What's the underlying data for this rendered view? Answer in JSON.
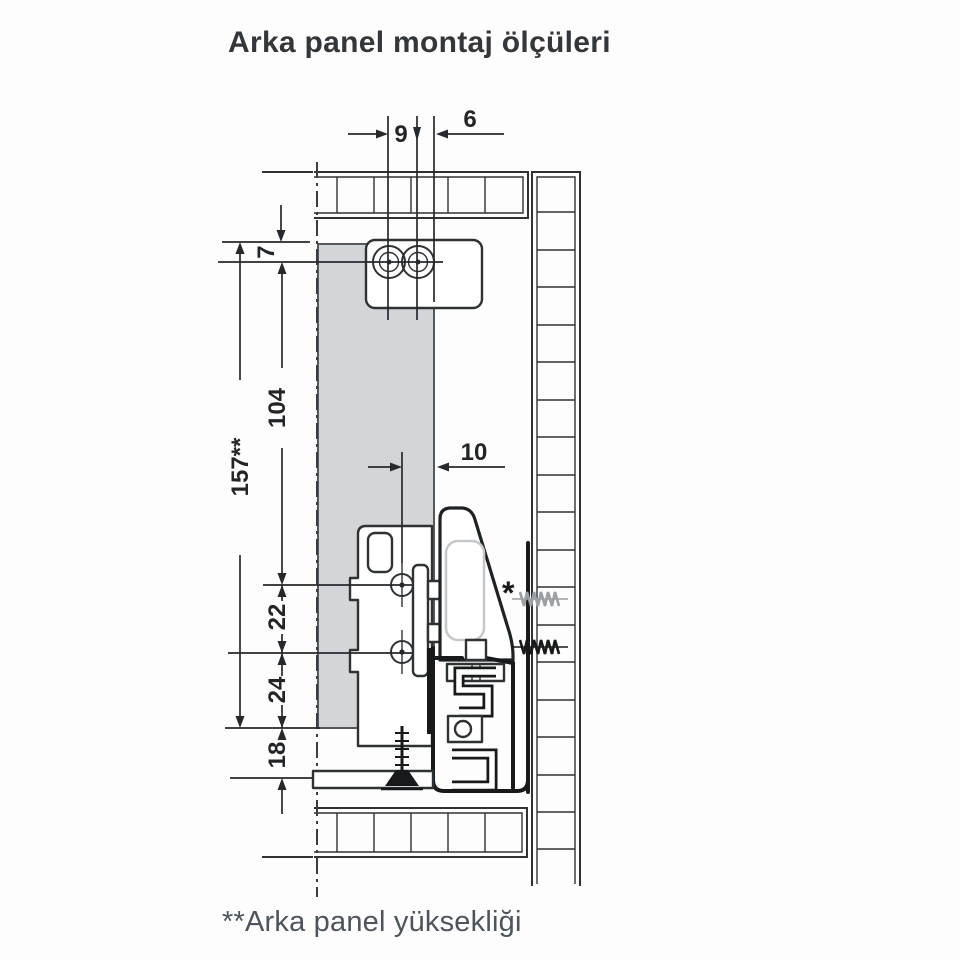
{
  "title": "Arka panel montaj ölçüleri",
  "footnote": "**Arka panel yüksekliği",
  "dimensions": {
    "screw_spacing_top": "9",
    "edge_offset_top": "6",
    "top_to_first_row": "7",
    "row_span": "104",
    "rear_panel_height": "157**",
    "screw_axis_offset": "10",
    "lower_row_spacing": "22",
    "last_row_to_bottom": "24",
    "bottom_clearance": "18"
  },
  "markers": {
    "optional_fixing": "*"
  },
  "colors": {
    "ink": "#2e3235",
    "runner_ink": "#17191a",
    "panel_fill": "#d3d6d8",
    "optional_screw": "#9ba0a4",
    "title_text": "#33373a",
    "footnote_text": "#4d545c"
  }
}
